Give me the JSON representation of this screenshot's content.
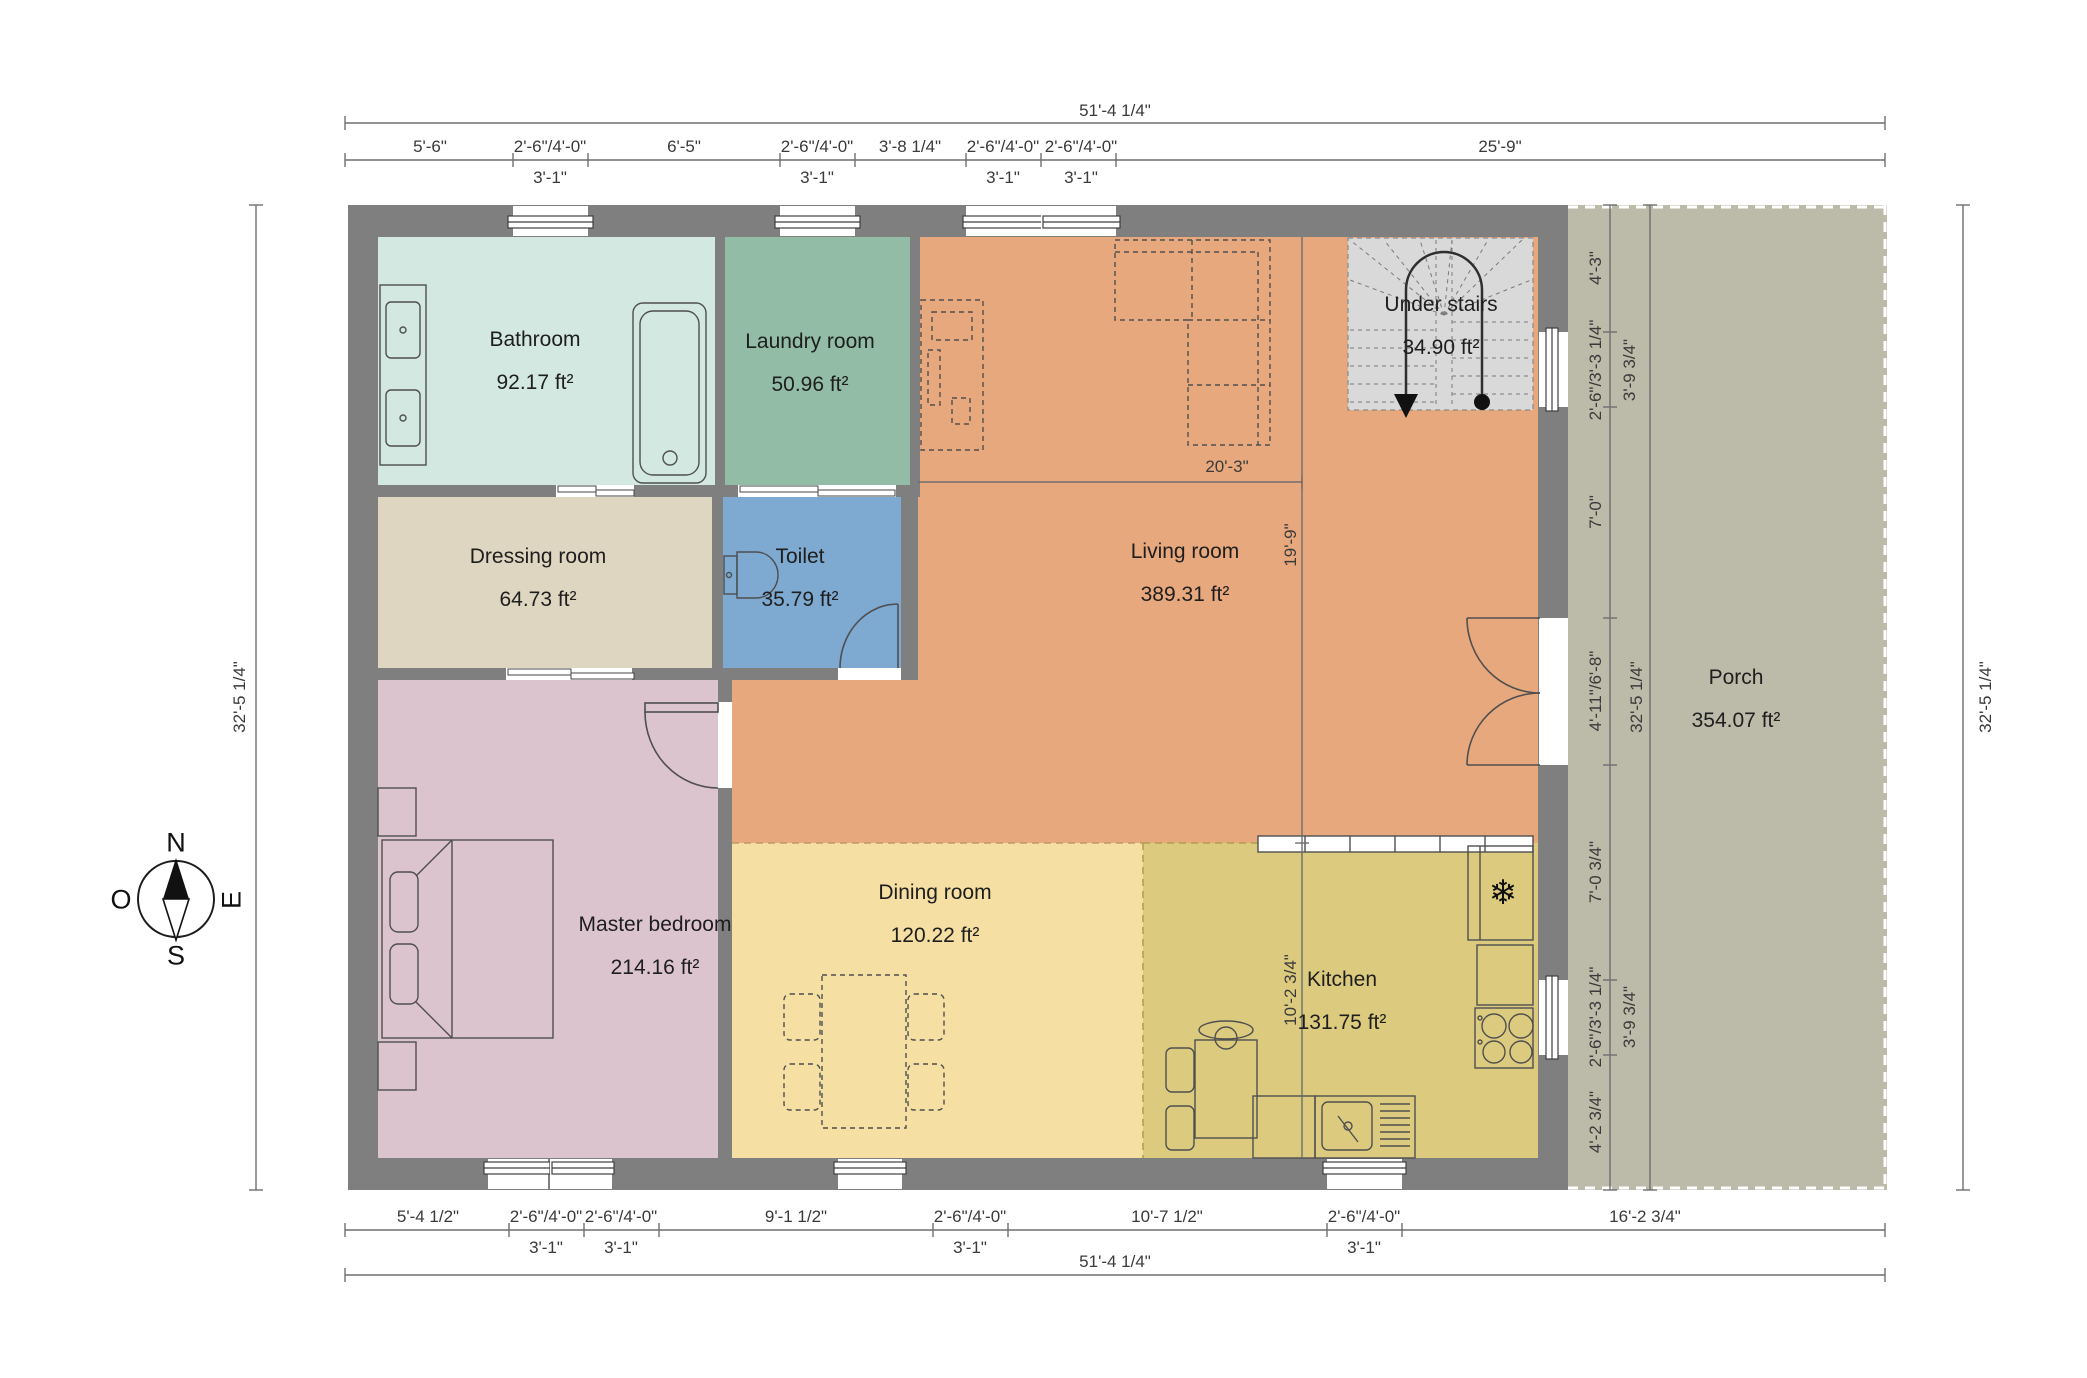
{
  "plan_title": "First floor plan",
  "rooms": [
    {
      "id": "bathroom",
      "name": "Bathroom",
      "area": "92.17 ft²",
      "color": "#d3e8e1"
    },
    {
      "id": "laundry",
      "name": "Laundry room",
      "area": "50.96 ft²",
      "color": "#92bca6"
    },
    {
      "id": "dressing",
      "name": "Dressing room",
      "area": "64.73 ft²",
      "color": "#ded6c1"
    },
    {
      "id": "toilet",
      "name": "Toilet",
      "area": "35.79 ft²",
      "color": "#7ea9d1"
    },
    {
      "id": "living",
      "name": "Living room",
      "area": "389.31 ft²",
      "color": "#e8a87d"
    },
    {
      "id": "understairs",
      "name": "Under stairs",
      "area": "34.90 ft²",
      "color": "#d9d9d9"
    },
    {
      "id": "master",
      "name": "Master bedroom",
      "area": "214.16 ft²",
      "color": "#dcc4ce"
    },
    {
      "id": "dining",
      "name": "Dining room",
      "area": "120.22 ft²",
      "color": "#f5dfa3"
    },
    {
      "id": "kitchen",
      "name": "Kitchen",
      "area": "131.75 ft²",
      "color": "#dccb7f"
    },
    {
      "id": "porch",
      "name": "Porch",
      "area": "354.07 ft²",
      "color": "#bcbaa9"
    }
  ],
  "compass": {
    "north": "N",
    "south": "S",
    "west": "O",
    "east": "E"
  },
  "icons": {
    "fridge_snowflake": "❄"
  },
  "colors": {
    "wall": "#7f7f7f",
    "background": "#ffffff",
    "dimension_line": "#6e6e6e",
    "furniture_line": "#4f4f4f"
  },
  "dimensions": {
    "top_overall": "51'-4 1/4\"",
    "top_segments": [
      "5'-6\"",
      "2'-6\"/4'-0\"",
      "6'-5\"",
      "2'-6\"/4'-0\"",
      "3'-8 1/4\"",
      "2'-6\"/4'-0\"",
      "2'-6\"/4'-0\"",
      "25'-9\""
    ],
    "top_sub": [
      "3'-1\"",
      "3'-1\"",
      "3'-1\"",
      "3'-1\""
    ],
    "bottom_segments": [
      "5'-4 1/2\"",
      "2'-6\"/4'-0\"",
      "2'-6\"/4'-0\"",
      "9'-1 1/2\"",
      "2'-6\"/4'-0\"",
      "10'-7 1/2\"",
      "2'-6\"/4'-0\"",
      "16'-2 3/4\""
    ],
    "bottom_sub": [
      "3'-1\"",
      "3'-1\"",
      "3'-1\"",
      "3'-1\""
    ],
    "bottom_overall": "51'-4 1/4\"",
    "left_overall": "32'-5 1/4\"",
    "right_segments": [
      "4'-3\"",
      "2'-6\"/3'-3 1/4\"",
      "7'-0\"",
      "4'-11\"/6'-8\"",
      "7'-0 3/4\"",
      "2'-6\"/3'-3 1/4\"",
      "4'-2 3/4\""
    ],
    "right_sub": [
      "3'-9 3/4\"",
      "3'-9 3/4\""
    ],
    "right_inner_overall": "32'-5 1/4\"",
    "right_outer_overall": "32'-5 1/4\"",
    "living_width": "20'-3\"",
    "living_depth": "19'-9\"",
    "kitchen_depth": "10'-2 3/4\""
  }
}
